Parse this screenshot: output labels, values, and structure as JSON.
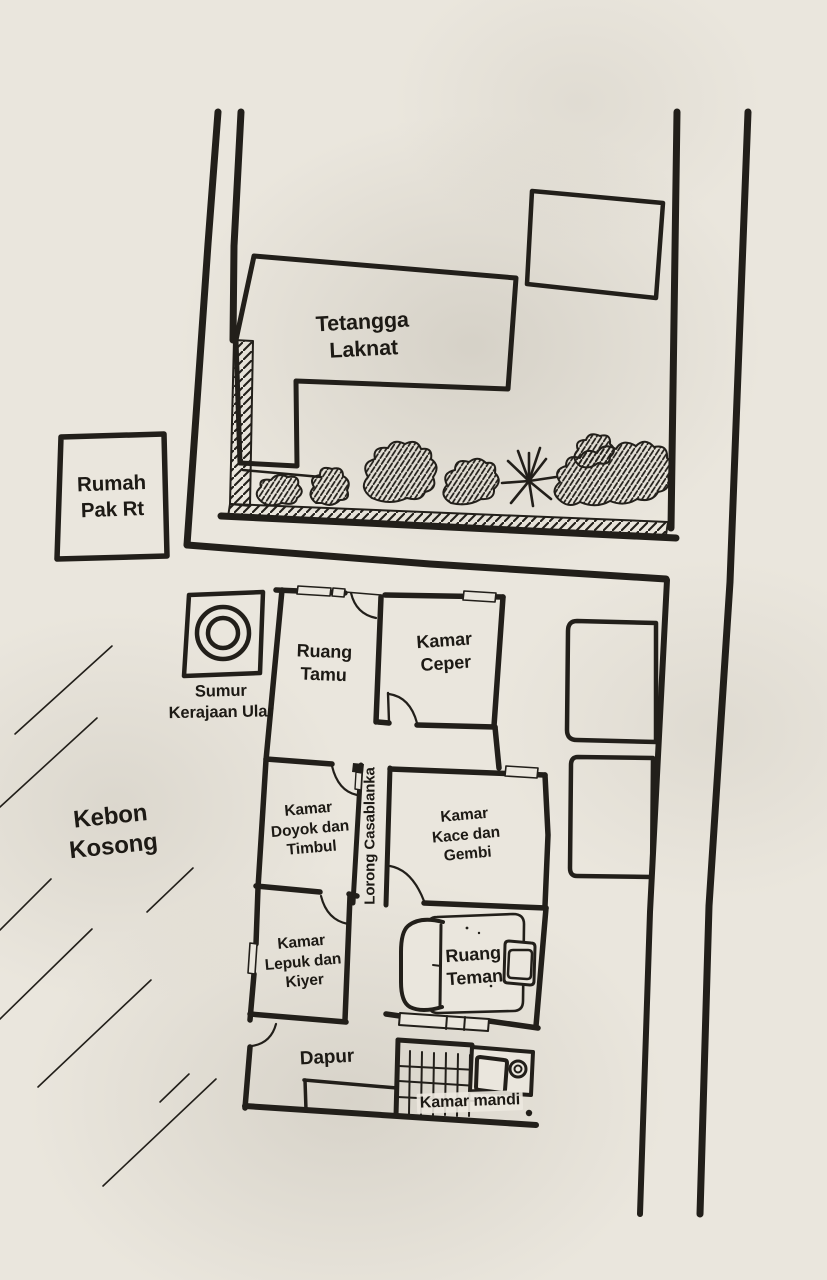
{
  "colors": {
    "ink": "#221f1a",
    "paper": "#eae6dd"
  },
  "map": {
    "neighbor_plot": {
      "house_label": "Tetangga\nLaknat"
    },
    "rt_house": {
      "label": "Rumah\nPak Rt"
    },
    "well": {
      "label": "Sumur\nKerajaan Ular"
    },
    "empty_garden": {
      "label": "Kebon\nKosong"
    },
    "house": {
      "rooms": {
        "ruang_tamu": "Ruang\nTamu",
        "kamar_ceper": "Kamar\nCeper",
        "kamar_doyok": "Kamar\nDoyok dan\nTimbul",
        "lorong_casablanka": "Lorong Casablanka",
        "kamar_kace": "Kamar\nKace dan\nGembi",
        "kamar_lepuk": "Kamar\nLepuk dan\nKiyer",
        "ruang_teman": "Ruang\nTeman",
        "dapur": "Dapur",
        "kamar_mandi": "Kamar mandi"
      }
    }
  }
}
